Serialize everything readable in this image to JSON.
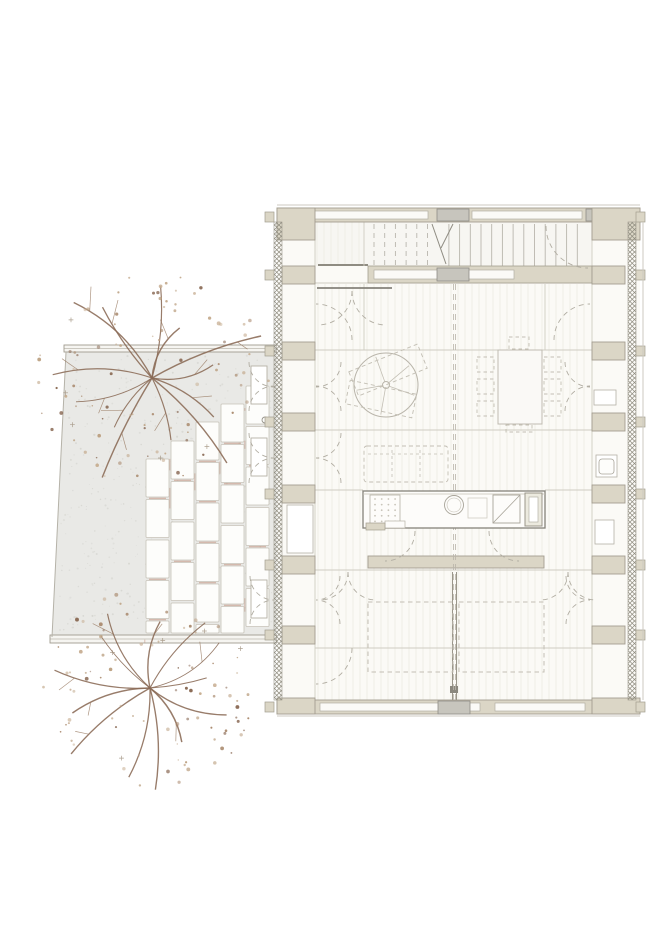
{
  "title": "architectural-floor-plan",
  "canvas": {
    "width": 670,
    "height": 947
  },
  "palette": {
    "background": "#ffffff",
    "terrace_fill": "#e9e9e6",
    "terrace_speckle": "#d7d7d2",
    "terrace_edge": "#a09c90",
    "paver_fill": "#fdfdfb",
    "paver_stroke": "#c6c2b8",
    "joint_accent": "#b06a50",
    "wall_beige": "#dbd6c6",
    "wall_stroke": "#a39e8f",
    "panel_gray": "#c7c5bd",
    "floor_fill": "#fbfaf6",
    "stair_fill": "#f7f6f2",
    "floor_stripe": "#efede6",
    "partition": "#cfccc1",
    "detail_dark": "#85827a",
    "dash_furniture": "#c3bfb4",
    "dash_door": "#b2aea3",
    "tread": "#b9b6ad",
    "hatch": "#8d8a7d",
    "branch": "#8a6a55",
    "twig": "#9a7c64",
    "plus_mark": "#9a8a76",
    "foliage": [
      "#aa8a6e",
      "#bda284",
      "#8a6a55",
      "#c7ae92"
    ]
  },
  "terrace": {
    "polygon": [
      [
        66,
        352
      ],
      [
        277,
        352
      ],
      [
        277,
        637
      ],
      [
        52,
        637
      ]
    ],
    "top_band": {
      "x": 64,
      "y": 345,
      "w": 213,
      "h": 7
    },
    "bottom_band": {
      "x": 50,
      "y": 635,
      "w": 227,
      "h": 8
    },
    "speckle_count": 430,
    "door_leaves": [
      [
        251,
        366,
        16,
        38
      ],
      [
        251,
        438,
        16,
        38
      ],
      [
        251,
        580,
        16,
        38
      ]
    ],
    "handle": {
      "cx": 265,
      "cy": 420,
      "r": 3
    }
  },
  "pavers": {
    "columns": [
      {
        "x": 246,
        "top": 386
      },
      {
        "x": 221,
        "top": 404
      },
      {
        "x": 196,
        "top": 422
      },
      {
        "x": 171,
        "top": 441
      },
      {
        "x": 146,
        "top": 459
      }
    ],
    "width": 23,
    "height": 38,
    "pitch": 40.5,
    "bottom": 633,
    "joint_seed": 99
  },
  "trees": [
    {
      "name": "tree-top",
      "cx": 152,
      "cy": 378,
      "spread": 118,
      "branches": 13,
      "dots": 88,
      "seed": 7
    },
    {
      "name": "tree-bottom",
      "cx": 150,
      "cy": 688,
      "spread": 108,
      "branches": 13,
      "dots": 88,
      "seed": 23
    }
  ],
  "building": {
    "outer": {
      "x": 277,
      "y": 208,
      "w": 363,
      "h": 508
    },
    "interior": {
      "x": 277,
      "y": 222,
      "w": 363,
      "h": 478
    },
    "bands": [
      {
        "x": 277,
        "y": 208,
        "w": 363,
        "h": 14
      },
      {
        "x": 277,
        "y": 700,
        "w": 363,
        "h": 14
      },
      {
        "x": 368,
        "y": 556,
        "w": 176,
        "h": 12
      }
    ],
    "white_insets": [
      [
        300,
        211,
        128,
        8
      ],
      [
        472,
        211,
        110,
        8
      ],
      [
        320,
        703,
        160,
        8
      ],
      [
        495,
        703,
        90,
        8
      ]
    ],
    "gray_panels": [
      [
        437,
        209,
        32,
        12
      ],
      [
        586,
        209,
        22,
        12
      ],
      [
        438,
        701,
        32,
        13
      ]
    ],
    "corner_piers": [
      [
        277,
        208,
        38,
        32
      ],
      [
        592,
        208,
        48,
        32
      ],
      [
        277,
        698,
        38,
        16
      ],
      [
        592,
        698,
        48,
        16
      ]
    ],
    "pier_rows": [
      266,
      342,
      413,
      485,
      556,
      626
    ],
    "pier_left_x": 282,
    "pier_right_x": 592,
    "pier_w": 33,
    "pier_h": 18,
    "hatch_strips": [
      [
        274,
        222,
        8,
        478
      ],
      [
        628,
        222,
        8,
        478
      ]
    ],
    "stub_left_x": 265,
    "stub_right_x": 636,
    "stub_w": 9,
    "stub_h": 10,
    "stair": {
      "x": 315,
      "y": 222,
      "w": 277,
      "h": 44,
      "tread_start": 374,
      "tread_end": 588,
      "step": 10.7,
      "dash_until": 434,
      "solid_from": 447,
      "break_lines": [
        [
          432,
          224,
          446,
          264
        ],
        [
          453,
          224,
          441,
          248
        ]
      ],
      "inner_band": {
        "x": 368,
        "y": 266,
        "w": 224,
        "h": 17
      },
      "inner_inset": {
        "x": 374,
        "y": 270,
        "w": 140,
        "h": 9
      },
      "inner_panel": {
        "x": 437,
        "y": 268,
        "w": 32,
        "h": 13
      },
      "rail": [
        318,
        265,
        368,
        265
      ],
      "landing_divider": [
        364,
        222,
        364,
        266
      ]
    },
    "partitions": [
      [
        315,
        222,
        315,
        700
      ],
      [
        592,
        222,
        592,
        700
      ],
      [
        315,
        283,
        592,
        283
      ],
      [
        315,
        350,
        592,
        350
      ],
      [
        315,
        430,
        592,
        430
      ],
      [
        315,
        490,
        363,
        490
      ],
      [
        545,
        490,
        592,
        490
      ],
      [
        315,
        570,
        592,
        570
      ],
      [
        315,
        648,
        592,
        648
      ],
      [
        364,
        284,
        364,
        350
      ],
      [
        545,
        284,
        545,
        350
      ]
    ],
    "door_header": [
      317,
      288,
      392,
      288
    ],
    "center_wall": {
      "lines": [
        [
          452.5,
          572,
          452.5,
          700
        ],
        [
          456.5,
          572,
          456.5,
          700
        ]
      ],
      "block": [
        450,
        686,
        8,
        7
      ]
    },
    "joint_dashed": [
      [
        453.5,
        284,
        453.5,
        700
      ],
      [
        455.5,
        284,
        455.5,
        700
      ]
    ],
    "niches": [
      {
        "x": 287,
        "y": 505,
        "w": 26,
        "h": 48
      },
      {
        "x": 594,
        "y": 390,
        "w": 22,
        "h": 15
      },
      {
        "x": 596,
        "y": 455,
        "w": 21,
        "h": 22
      },
      {
        "x": 595,
        "y": 520,
        "w": 19,
        "h": 24
      }
    ],
    "toilet_inner": {
      "x": 599,
      "y": 459,
      "w": 15,
      "h": 15
    },
    "ext_lines": [
      [
        277,
        205,
        640,
        205
      ],
      [
        643,
        222,
        643,
        700
      ],
      [
        277,
        716,
        640,
        716
      ]
    ],
    "floor_stripe_step": 7
  },
  "furniture": {
    "round_table": {
      "cx": 386,
      "cy": 385,
      "r": 32,
      "hub": 3.5,
      "spokes": [
        20,
        100,
        170,
        250,
        320
      ],
      "loungers": [
        {
          "cx": 388,
          "cy": 370,
          "w": 74,
          "h": 26,
          "rot": -22
        },
        {
          "cx": 381,
          "cy": 399,
          "w": 68,
          "h": 24,
          "rot": 12
        }
      ]
    },
    "dining": {
      "table": {
        "x": 498,
        "y": 350,
        "w": 44,
        "h": 74
      },
      "chairs": [
        [
          477,
          357,
          17,
          15
        ],
        [
          477,
          379,
          17,
          15
        ],
        [
          477,
          401,
          17,
          15
        ],
        [
          544,
          357,
          17,
          15
        ],
        [
          544,
          379,
          17,
          15
        ],
        [
          544,
          401,
          17,
          15
        ],
        [
          509,
          337,
          20,
          12
        ],
        [
          506,
          425,
          26,
          7
        ]
      ]
    },
    "sofa": {
      "x": 364,
      "y": 446,
      "w": 84,
      "h": 36,
      "dividers": [
        392,
        420
      ]
    },
    "island": {
      "body": {
        "x": 363,
        "y": 491,
        "w": 182,
        "h": 37
      },
      "hob": {
        "x": 370,
        "y": 495,
        "w": 30,
        "h": 30
      },
      "hob_tray": {
        "x": 385,
        "y": 521,
        "w": 20,
        "h": 7
      },
      "sink": {
        "cx": 454,
        "cy": 505,
        "r": 9.5,
        "inner": 7
      },
      "board": {
        "x": 468,
        "y": 498,
        "w": 19,
        "h": 20
      },
      "dw": {
        "x": 493,
        "y": 495,
        "w": 27,
        "h": 28
      },
      "tall": {
        "x": 525,
        "y": 493,
        "w": 17,
        "h": 33,
        "inner": {
          "x": 529,
          "y": 497,
          "w": 9,
          "h": 25
        }
      },
      "base_left": {
        "x": 366,
        "y": 523,
        "w": 19,
        "h": 7
      }
    },
    "beds": [
      [
        368,
        602,
        85,
        70
      ],
      [
        459,
        602,
        85,
        70
      ]
    ]
  },
  "door_arcs": [
    [
      316,
      362,
      25,
      0,
      90
    ],
    [
      316,
      411,
      25,
      0,
      -90
    ],
    [
      316,
      433,
      25,
      0,
      90
    ],
    [
      316,
      483,
      25,
      0,
      -90
    ],
    [
      316,
      576,
      24,
      0,
      90
    ],
    [
      316,
      624,
      24,
      0,
      -90
    ],
    [
      316,
      340,
      36,
      0,
      -90
    ],
    [
      316,
      648,
      36,
      0,
      90
    ],
    [
      274,
      362,
      25,
      180,
      90
    ],
    [
      274,
      411,
      25,
      180,
      270
    ],
    [
      274,
      433,
      25,
      180,
      90
    ],
    [
      274,
      483,
      25,
      180,
      270
    ],
    [
      274,
      576,
      24,
      180,
      90
    ],
    [
      274,
      624,
      24,
      180,
      270
    ],
    [
      590,
      340,
      36,
      180,
      270
    ],
    [
      590,
      362,
      25,
      180,
      90
    ],
    [
      590,
      411,
      25,
      180,
      270
    ],
    [
      590,
      576,
      24,
      180,
      90
    ],
    [
      590,
      624,
      24,
      180,
      270
    ],
    [
      588,
      226,
      42,
      180,
      90
    ],
    [
      318,
      291,
      34,
      0,
      90
    ],
    [
      386,
      291,
      34,
      180,
      90
    ],
    [
      385,
      531,
      30,
      0,
      90
    ],
    [
      519,
      531,
      30,
      180,
      90
    ],
    [
      320,
      572,
      28,
      0,
      90
    ],
    [
      376,
      572,
      28,
      180,
      90
    ],
    [
      540,
      572,
      28,
      0,
      90
    ],
    [
      596,
      572,
      28,
      180,
      90
    ]
  ]
}
